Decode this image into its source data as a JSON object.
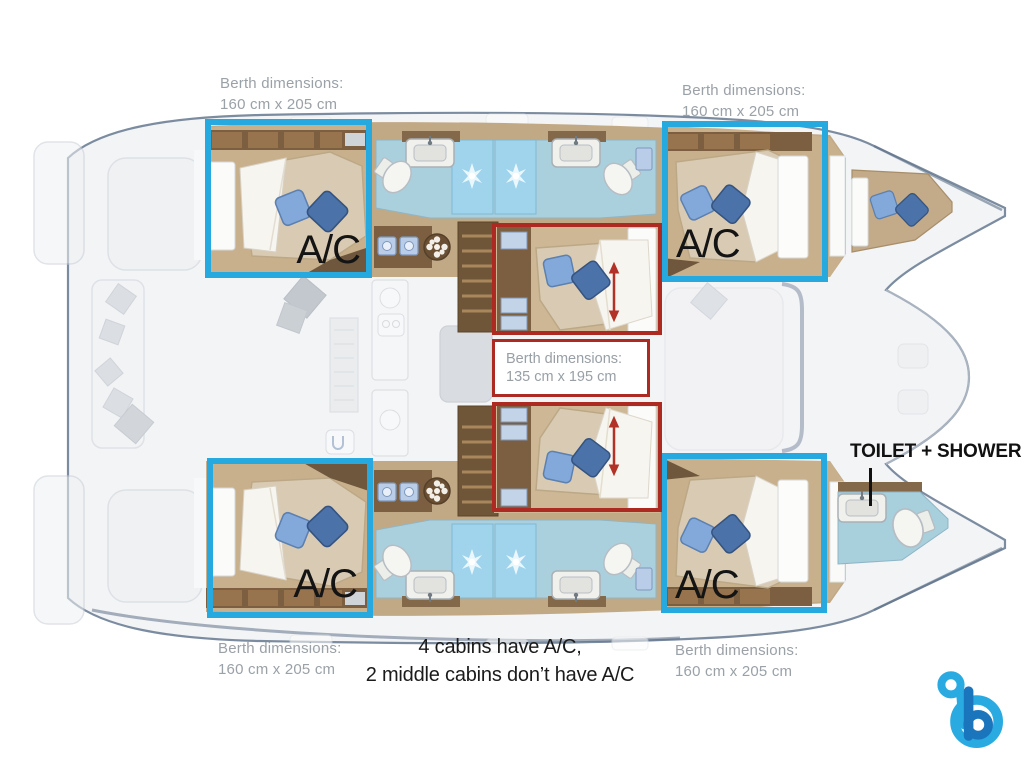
{
  "colors": {
    "highlight_blue": "#25a9de",
    "highlight_red": "#ac2a22",
    "caption_gray": "#9aa1a7",
    "label_black": "#141414",
    "logo_light_blue": "#29abe2",
    "logo_dark_blue": "#1b75bc"
  },
  "annotations": {
    "berth_top_left": {
      "line1": "Berth dimensions:",
      "line2": "160 cm x 205 cm"
    },
    "berth_top_right": {
      "line1": "Berth dimensions:",
      "line2": "160 cm x 205 cm"
    },
    "berth_bottom_left": {
      "line1": "Berth dimensions:",
      "line2": "160 cm x 205 cm"
    },
    "berth_bottom_right": {
      "line1": "Berth dimensions:",
      "line2": "160 cm x 205 cm"
    },
    "berth_middle": {
      "line1": "Berth dimensions:",
      "line2": "135 cm x 195 cm"
    },
    "ac_label": "A/C",
    "toilet_shower": "TOILET + SHOWER",
    "footnote_line1": "4 cabins have A/C,",
    "footnote_line2": "2 middle cabins don’t have A/C"
  },
  "logo": {
    "letter": "b"
  }
}
